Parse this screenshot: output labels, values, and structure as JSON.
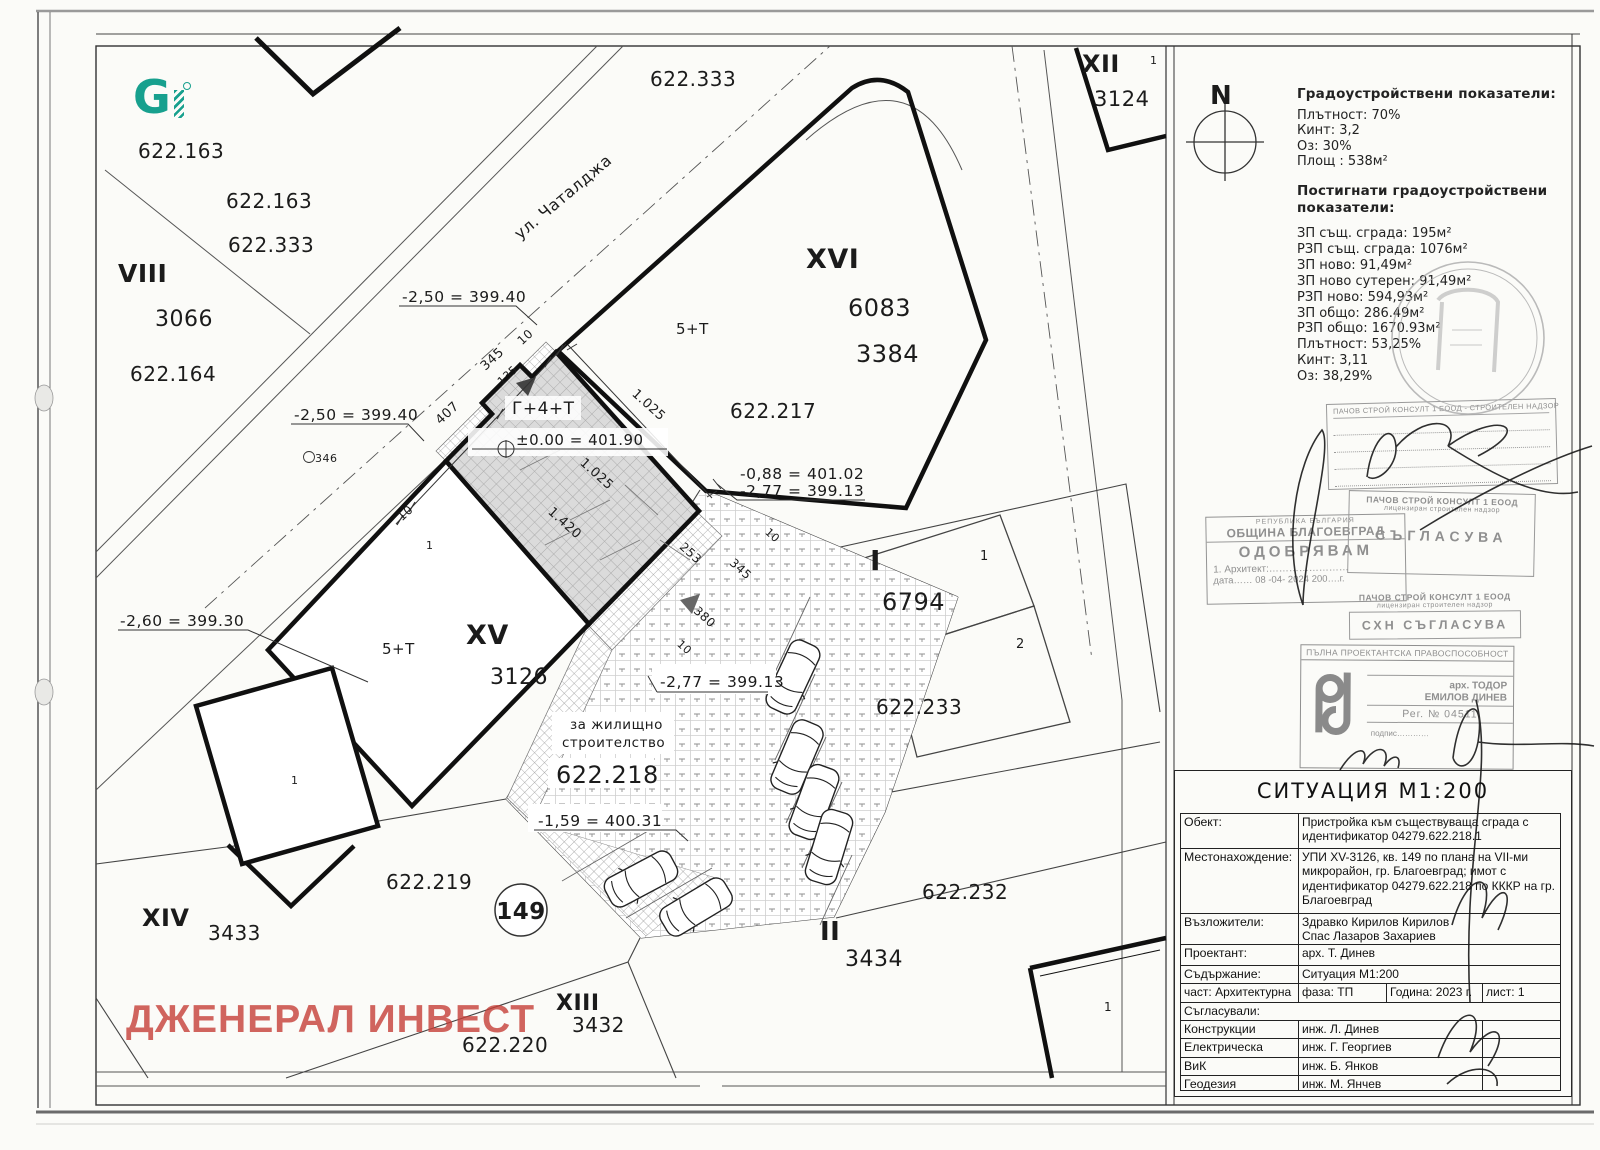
{
  "logo": {
    "g": "G"
  },
  "watermark": {
    "text": "ДЖЕНЕРАЛ ИНВЕСТ",
    "color": "#c63e37"
  },
  "panel": {
    "north": "N",
    "indicators_title": "Градоустройствени показатели:",
    "indicators": [
      "Плътност: 70%",
      "Кинт: 3,2",
      "Оз: 30%",
      "Площ : 538м²"
    ],
    "achieved_title1": "Постигнати градоустройствени",
    "achieved_title2": "показатели:",
    "achieved": [
      "ЗП същ. сграда: 195м²",
      "РЗП същ. сграда: 1076м²",
      "ЗП ново: 91,49м²",
      "ЗП ново сутерен: 91,49м²",
      "РЗП ново: 594,93м²",
      "ЗП общо: 286.49м²",
      "РЗП общо: 1670.93м²",
      "Плътност: 53,25%",
      "Кинт: 3,11",
      "Оз: 38,29%"
    ]
  },
  "stamps": {
    "nadzor_l1": "ПАЧОВ СТРОЙ КОНСУЛТ 1 ЕООД - СТРОИТЕЛЕН НАДЗОР",
    "mun_l1": "РЕПУБЛИКА БЪЛГАРИЯ",
    "mun_l2": "ОБЩИНА БЛАГОЕВГРАД",
    "mun_l3": "ОДОБРЯВАМ",
    "mun_l4": "1. Архитект:……………………",
    "mun_l5": "дата…… 08 -04- 2024 200….г.",
    "a1_l1": "ПАЧОВ СТРОЙ КОНСУЛТ 1 ЕООД",
    "a1_l2": "лицензиран строителен надзор",
    "a1_l3": "СЪГЛАСУВА",
    "a2_l1": "ПАЧОВ СТРОЙ КОНСУЛТ 1 ЕООД",
    "a2_l2": "лицензиран строителен надзор",
    "a2_l3": "СХН СЪГЛАСУВА",
    "kab_header": "ПЪЛНА ПРОЕКТАНТСКА ПРАВОСПОСОБНОСТ",
    "kab_name1": "арх. ТОДОР",
    "kab_name2": "ЕМИЛОВ ДИНЕВ",
    "kab_reg": "Рег. № 04511",
    "kab_sign": "подпис…………"
  },
  "titleblock": {
    "title": "СИТУАЦИЯ М1:200",
    "rows": [
      {
        "label": "Обект:",
        "value": "Пристройка към съществуваща сграда с идентификатор 04279.622.218.1"
      },
      {
        "label": "Местонахождение:",
        "value": "УПИ XV-3126, кв. 149 по плана на VII-ми микрорайон, гр. Благоевград; имот с идентификатор 04279.622.218 по КККР на гр. Благоевград"
      },
      {
        "label": "Възложители:",
        "value": "Здравко Кирилов Кирилов\nСпас Лазаров Захариев"
      },
      {
        "label": "Проектант:",
        "value": "арх. Т. Динев"
      },
      {
        "label": "Съдържание:",
        "value": "Ситуация М1:200"
      }
    ],
    "meta": {
      "part": "част: Архитектурна",
      "phase": "фаза: ТП",
      "year": "Година: 2023 г.",
      "sheet": "лист: 1"
    },
    "agreed_label": "Съгласували:",
    "agreed": [
      {
        "label": "Конструкции",
        "value": "инж. Л. Динев"
      },
      {
        "label": "Електрическа",
        "value": "инж. Г. Георгиев"
      },
      {
        "label": "ВиК",
        "value": "инж. Б. Янков"
      },
      {
        "label": "Геодезия",
        "value": "инж. М. Янчев"
      }
    ]
  },
  "map": {
    "ml": [
      {
        "t": "622.163"
      },
      {
        "t": "622.163"
      },
      {
        "t": "622.333"
      },
      {
        "t": "VIII"
      },
      {
        "t": "3066"
      },
      {
        "t": "622.164"
      },
      {
        "t": "622.333"
      },
      {
        "t": "ул. Чаталджа"
      },
      {
        "t": "XII"
      },
      {
        "t": "3124"
      },
      {
        "t": "XVI"
      },
      {
        "t": "6083"
      },
      {
        "t": "3384"
      },
      {
        "t": "622.217"
      },
      {
        "t": "5+Т"
      },
      {
        "t": "5+Т"
      },
      {
        "t": "XV"
      },
      {
        "t": "3126"
      },
      {
        "t": "Г+4+Т"
      },
      {
        "t": "±0.00 = 401.90"
      },
      {
        "t": "-2,50 = 399.40"
      },
      {
        "t": "-2,50 = 399.40"
      },
      {
        "t": "-2,60 = 399.30"
      },
      {
        "t": "-0,88 = 401.02"
      },
      {
        "t": "-2,77 = 399.13"
      },
      {
        "t": "-2,77 = 399.13"
      },
      {
        "t": "-1,59 = 400.31"
      },
      {
        "t": "за жилищно"
      },
      {
        "t": "строителство"
      },
      {
        "t": "622.218"
      },
      {
        "t": "622.219"
      },
      {
        "t": "XIV"
      },
      {
        "t": "3433"
      },
      {
        "t": "149"
      },
      {
        "t": "II"
      },
      {
        "t": "3434"
      },
      {
        "t": "622.232"
      },
      {
        "t": "XIII"
      },
      {
        "t": "3432"
      },
      {
        "t": "622.220"
      },
      {
        "t": "I"
      },
      {
        "t": "6794"
      },
      {
        "t": "622.233"
      },
      {
        "t": "1"
      },
      {
        "t": "2"
      },
      {
        "t": "346"
      },
      {
        "t": "1"
      },
      {
        "t": "1"
      },
      {
        "t": "1"
      },
      {
        "t": "1"
      },
      {
        "t": "10"
      },
      {
        "t": "407"
      },
      {
        "t": "345"
      },
      {
        "t": "10"
      },
      {
        "t": "135"
      },
      {
        "t": "1.025"
      },
      {
        "t": "1.025"
      },
      {
        "t": "1.420"
      },
      {
        "t": "253"
      },
      {
        "t": "345"
      },
      {
        "t": "380"
      },
      {
        "t": "10"
      },
      {
        "t": "10"
      },
      {
        "t": "N"
      }
    ]
  }
}
